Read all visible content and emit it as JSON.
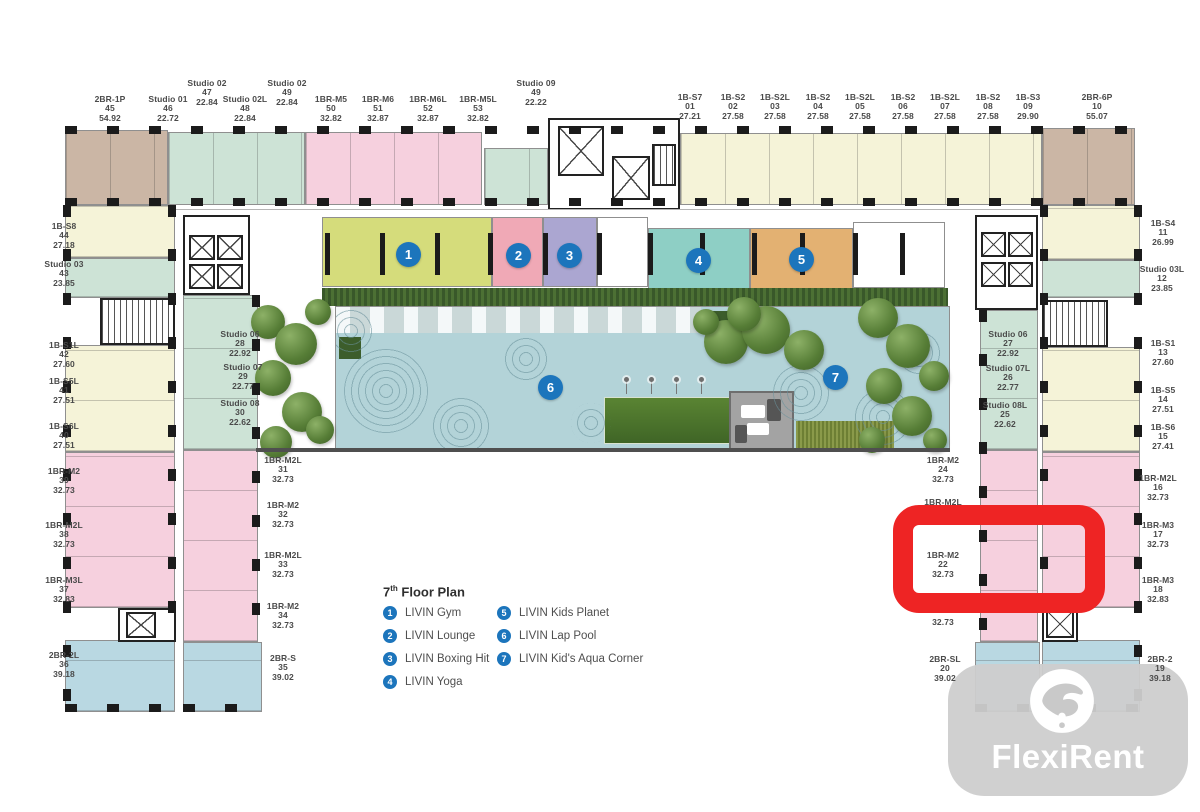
{
  "plan": {
    "building": "LIVIN",
    "floor_title": "7th Floor Plan",
    "title_prefix": "7",
    "title_sup": "th",
    "title_rest": " Floor Plan"
  },
  "legend": {
    "items": [
      {
        "num": "1",
        "label": "LIVIN Gym"
      },
      {
        "num": "2",
        "label": "LIVIN Lounge"
      },
      {
        "num": "3",
        "label": "LIVIN Boxing Hit"
      },
      {
        "num": "4",
        "label": "LIVIN Yoga"
      },
      {
        "num": "5",
        "label": "LIVIN Kids Planet"
      },
      {
        "num": "6",
        "label": "LIVIN Lap Pool"
      },
      {
        "num": "7",
        "label": "LIVIN Kid's Aqua Corner"
      }
    ]
  },
  "markers": [
    {
      "num": "1",
      "x": 408,
      "y": 254
    },
    {
      "num": "2",
      "x": 518,
      "y": 255
    },
    {
      "num": "3",
      "x": 569,
      "y": 255
    },
    {
      "num": "4",
      "x": 698,
      "y": 260
    },
    {
      "num": "5",
      "x": 801,
      "y": 259
    },
    {
      "num": "6",
      "x": 550,
      "y": 387
    },
    {
      "num": "7",
      "x": 835,
      "y": 377
    }
  ],
  "unit_labels": [
    {
      "name": "2BR-1P",
      "no": "45",
      "area": "54.92",
      "x": 110,
      "y": 95
    },
    {
      "name": "Studio 01",
      "no": "46",
      "area": "22.72",
      "x": 168,
      "y": 95
    },
    {
      "name": "Studio 02",
      "no": "47",
      "area": "22.84",
      "x": 207,
      "y": 79
    },
    {
      "name": "Studio 02L",
      "no": "48",
      "area": "22.84",
      "x": 245,
      "y": 95
    },
    {
      "name": "Studio 02",
      "no": "49",
      "area": "22.84",
      "x": 287,
      "y": 79
    },
    {
      "name": "1BR-M5",
      "no": "50",
      "area": "32.82",
      "x": 331,
      "y": 95
    },
    {
      "name": "1BR-M6",
      "no": "51",
      "area": "32.87",
      "x": 378,
      "y": 95
    },
    {
      "name": "1BR-M6L",
      "no": "52",
      "area": "32.87",
      "x": 428,
      "y": 95
    },
    {
      "name": "1BR-M5L",
      "no": "53",
      "area": "32.82",
      "x": 478,
      "y": 95
    },
    {
      "name": "Studio 09",
      "no": "49",
      "area": "22.22",
      "x": 536,
      "y": 79
    },
    {
      "name": "1B-S7",
      "no": "01",
      "area": "27.21",
      "x": 690,
      "y": 93
    },
    {
      "name": "1B-S2",
      "no": "02",
      "area": "27.58",
      "x": 733,
      "y": 93
    },
    {
      "name": "1B-S2L",
      "no": "03",
      "area": "27.58",
      "x": 775,
      "y": 93
    },
    {
      "name": "1B-S2",
      "no": "04",
      "area": "27.58",
      "x": 818,
      "y": 93
    },
    {
      "name": "1B-S2L",
      "no": "05",
      "area": "27.58",
      "x": 860,
      "y": 93
    },
    {
      "name": "1B-S2",
      "no": "06",
      "area": "27.58",
      "x": 903,
      "y": 93
    },
    {
      "name": "1B-S2L",
      "no": "07",
      "area": "27.58",
      "x": 945,
      "y": 93
    },
    {
      "name": "1B-S2",
      "no": "08",
      "area": "27.58",
      "x": 988,
      "y": 93
    },
    {
      "name": "1B-S3",
      "no": "09",
      "area": "29.90",
      "x": 1028,
      "y": 93
    },
    {
      "name": "2BR-6P",
      "no": "10",
      "area": "55.07",
      "x": 1097,
      "y": 93
    },
    {
      "name": "1B-S4",
      "no": "11",
      "area": "26.99",
      "x": 1163,
      "y": 219
    },
    {
      "name": "Studio 03L",
      "no": "12",
      "area": "23.85",
      "x": 1162,
      "y": 265
    },
    {
      "name": "1B-S1",
      "no": "13",
      "area": "27.60",
      "x": 1163,
      "y": 339
    },
    {
      "name": "1B-S5",
      "no": "14",
      "area": "27.51",
      "x": 1163,
      "y": 386
    },
    {
      "name": "1B-S6",
      "no": "15",
      "area": "27.41",
      "x": 1163,
      "y": 423
    },
    {
      "name": "1BR-M2L",
      "no": "16",
      "area": "32.73",
      "x": 1158,
      "y": 474
    },
    {
      "name": "1BR-M3",
      "no": "17",
      "area": "32.73",
      "x": 1158,
      "y": 521
    },
    {
      "name": "1BR-M3",
      "no": "18",
      "area": "32.83",
      "x": 1158,
      "y": 576
    },
    {
      "name": "2BR-2",
      "no": "19",
      "area": "39.18",
      "x": 1160,
      "y": 655
    },
    {
      "name": "1B-S8",
      "no": "44",
      "area": "27.18",
      "x": 64,
      "y": 222
    },
    {
      "name": "Studio 03",
      "no": "43",
      "area": "23.85",
      "x": 64,
      "y": 260
    },
    {
      "name": "1B-S1L",
      "no": "42",
      "area": "27.60",
      "x": 64,
      "y": 341
    },
    {
      "name": "1B-S5L",
      "no": "41",
      "area": "27.51",
      "x": 64,
      "y": 377
    },
    {
      "name": "1B-S6L",
      "no": "40",
      "area": "27.51",
      "x": 64,
      "y": 422
    },
    {
      "name": "1BR-M2",
      "no": "39",
      "area": "32.73",
      "x": 64,
      "y": 467
    },
    {
      "name": "1BR-M2L",
      "no": "38",
      "area": "32.73",
      "x": 64,
      "y": 521
    },
    {
      "name": "1BR-M3L",
      "no": "37",
      "area": "32.83",
      "x": 64,
      "y": 576
    },
    {
      "name": "2BR-2L",
      "no": "36",
      "area": "39.18",
      "x": 64,
      "y": 651
    },
    {
      "name": "Studio 06",
      "no": "28",
      "area": "22.92",
      "x": 240,
      "y": 330
    },
    {
      "name": "Studio 07",
      "no": "29",
      "area": "22.77",
      "x": 243,
      "y": 363
    },
    {
      "name": "Studio 08",
      "no": "30",
      "area": "22.62",
      "x": 240,
      "y": 399
    },
    {
      "name": "1BR-M2L",
      "no": "31",
      "area": "32.73",
      "x": 283,
      "y": 456
    },
    {
      "name": "1BR-M2",
      "no": "32",
      "area": "32.73",
      "x": 283,
      "y": 501
    },
    {
      "name": "1BR-M2L",
      "no": "33",
      "area": "32.73",
      "x": 283,
      "y": 551
    },
    {
      "name": "1BR-M2",
      "no": "34",
      "area": "32.73",
      "x": 283,
      "y": 602
    },
    {
      "name": "2BR-S",
      "no": "35",
      "area": "39.02",
      "x": 283,
      "y": 654
    },
    {
      "name": "Studio 06",
      "no": "27",
      "area": "22.92",
      "x": 1008,
      "y": 330
    },
    {
      "name": "Studio 07L",
      "no": "26",
      "area": "22.77",
      "x": 1008,
      "y": 364
    },
    {
      "name": "Studio 08L",
      "no": "25",
      "area": "22.62",
      "x": 1005,
      "y": 401
    },
    {
      "name": "1BR-M2",
      "no": "24",
      "area": "32.73",
      "x": 943,
      "y": 456
    },
    {
      "name": "1BR-M2L",
      "no": "23",
      "area": "32.73",
      "x": 943,
      "y": 498
    },
    {
      "name": "1BR-M2",
      "no": "22",
      "area": "32.73",
      "x": 943,
      "y": 551
    },
    {
      "name": "",
      "no": "",
      "area": "32.73",
      "x": 943,
      "y": 618
    },
    {
      "name": "2BR-SL",
      "no": "20",
      "area": "39.02",
      "x": 945,
      "y": 655
    }
  ],
  "highlight": {
    "unit_name": "1BR-M2",
    "unit_no": "22",
    "color": "#ee2424"
  },
  "watermark": {
    "brand": "FlexiRent"
  },
  "colors": {
    "marker_blue": "#1c75bc",
    "highlight_red": "#ee2424",
    "unit_studio_green": "#cde3d6",
    "unit_1br_pink": "#f6d0de",
    "unit_1bs_yellow": "#f5f3d8",
    "unit_2br_blue": "#b9d8e2",
    "unit_2br_tan": "#cbb6a5",
    "gym": "#d5dc7b",
    "lounge": "#f0a9b6",
    "boxing": "#aba6d1",
    "yoga": "#8ecfc5",
    "kids_planet": "#e3b172",
    "pool_water": "#b3d3d8",
    "watermark_gray": "#cdcdcd"
  }
}
